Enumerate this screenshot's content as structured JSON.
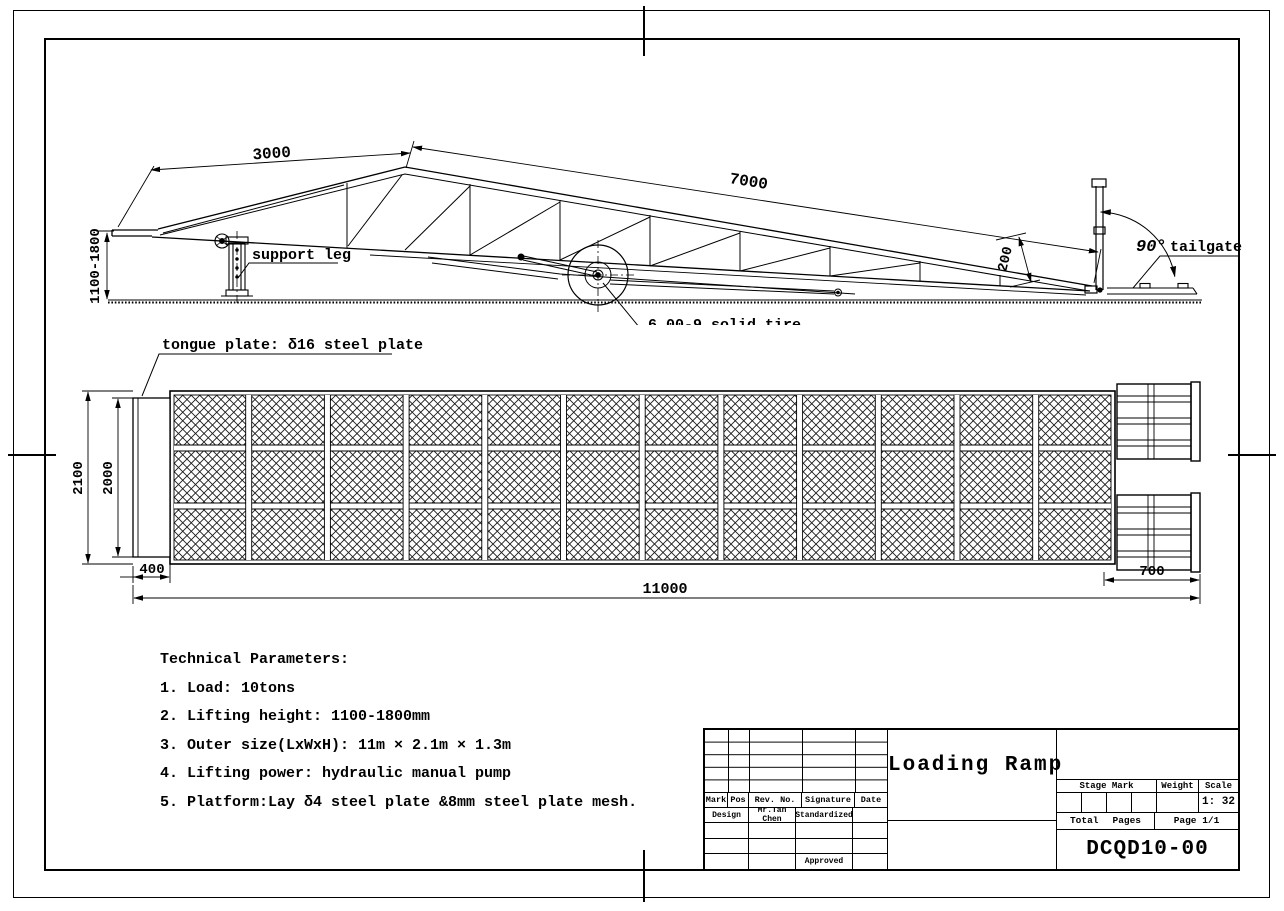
{
  "side_view": {
    "dim_top_left": "3000",
    "dim_slope": "7000",
    "dim_height": "1100-1800",
    "dim_depth": "200",
    "support_leg_label": "support leg",
    "tire_label": "6.00-9 solid tire",
    "angle_label": "90°",
    "tailgate_label": "tailgate"
  },
  "top_view": {
    "tongue_label": "tongue plate: δ16 steel plate",
    "dim_width_total": "2100",
    "dim_width_tongue": "2000",
    "dim_tongue_len": "400",
    "dim_length_total": "11000",
    "dim_tailgate_len": "700"
  },
  "technical_parameters": {
    "title": "Technical Parameters:",
    "items": [
      "1. Load: 10tons",
      "2. Lifting height: 1100-1800mm",
      "3. Outer size(LxWxH): 11m × 2.1m × 1.3m",
      "4. Lifting power: hydraulic manual pump",
      "5. Platform:Lay δ4 steel plate &8mm steel plate mesh."
    ]
  },
  "title_block": {
    "product_title": "Loading Ramp",
    "drawing_number": "DCQD10-00",
    "rev_headers": [
      "Mark",
      "Pos",
      "Rev. No.",
      "Signature",
      "Date"
    ],
    "design_label": "Design",
    "designer": "Mr.Tan Chen",
    "standardized_label": "Standardized",
    "approved_label": "Approved",
    "stage_mark_label": "Stage Mark",
    "weight_label": "Weight",
    "scale_label": "Scale",
    "scale_value": "1: 32",
    "total_label": "Total",
    "pages_label": "Pages",
    "page_value": "Page 1/1"
  }
}
